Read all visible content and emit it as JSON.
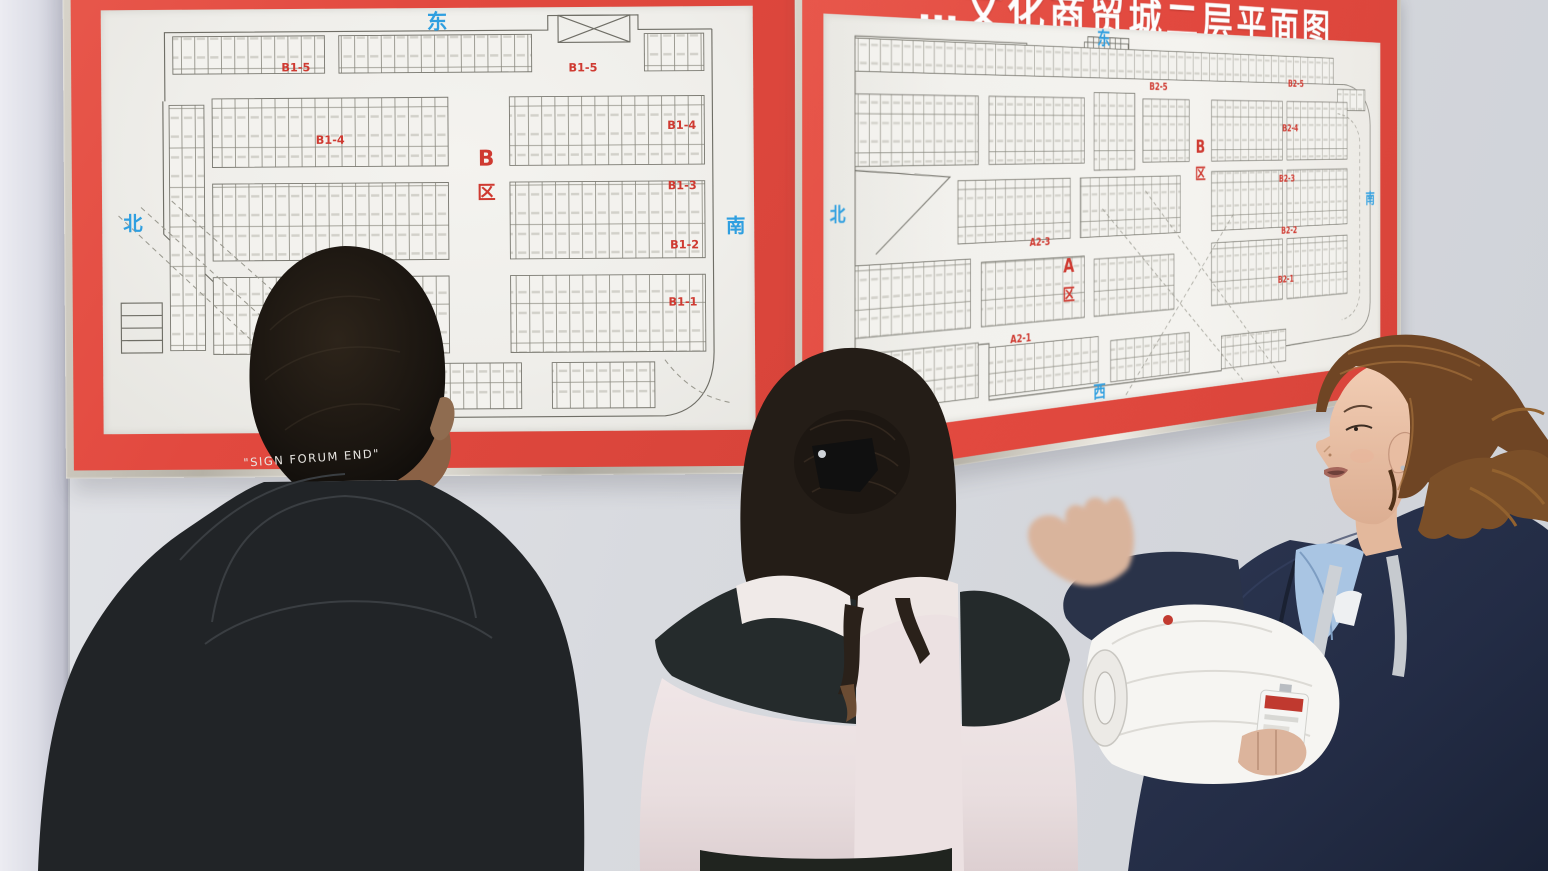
{
  "scene": {
    "description": "Two customers viewing two framed market floor plans while a consultant in a navy blazer presents",
    "wall_color": "#d8dadf",
    "frame_mat_red": "#e2493f",
    "frame_metal": "#cfccc2",
    "plan_paper": "#f2f1ed",
    "label_blue": "#2f9fe0",
    "label_red": "#cf3a31"
  },
  "banner": {
    "title_partial": "…文化商贸城二层平面图"
  },
  "left_plan": {
    "dir_top": "东",
    "dir_left": "北",
    "dir_right": "南",
    "dir_bottom": "西",
    "zone_b": "B",
    "zone_b_char": "区",
    "zone_a": "A",
    "sections": {
      "b1_5a": "B1-5",
      "b1_5b": "B1-5",
      "b1_4a": "B1-4",
      "b1_4b": "B1-4",
      "b1_3": "B1-3",
      "b1_2": "B1-2",
      "b1_1": "B1-1",
      "a1_1": "A1-1"
    }
  },
  "right_plan": {
    "dir_top": "东",
    "dir_left": "北",
    "dir_right": "南",
    "dir_bottom": "西",
    "zone_b": "B",
    "zone_b_char": "区",
    "zone_a": "A",
    "zone_a_char": "区",
    "sections": {
      "b2_5a": "B2-5",
      "b2_5b": "B2-5",
      "b2_4": "B2-4",
      "b2_3": "B2-3",
      "b2_2": "B2-2",
      "b2_1": "B2-1",
      "a2_3": "A2-3",
      "a2_1": "A2-1"
    }
  },
  "people": {
    "hood_text": "\"SIGN FORUM END\""
  }
}
